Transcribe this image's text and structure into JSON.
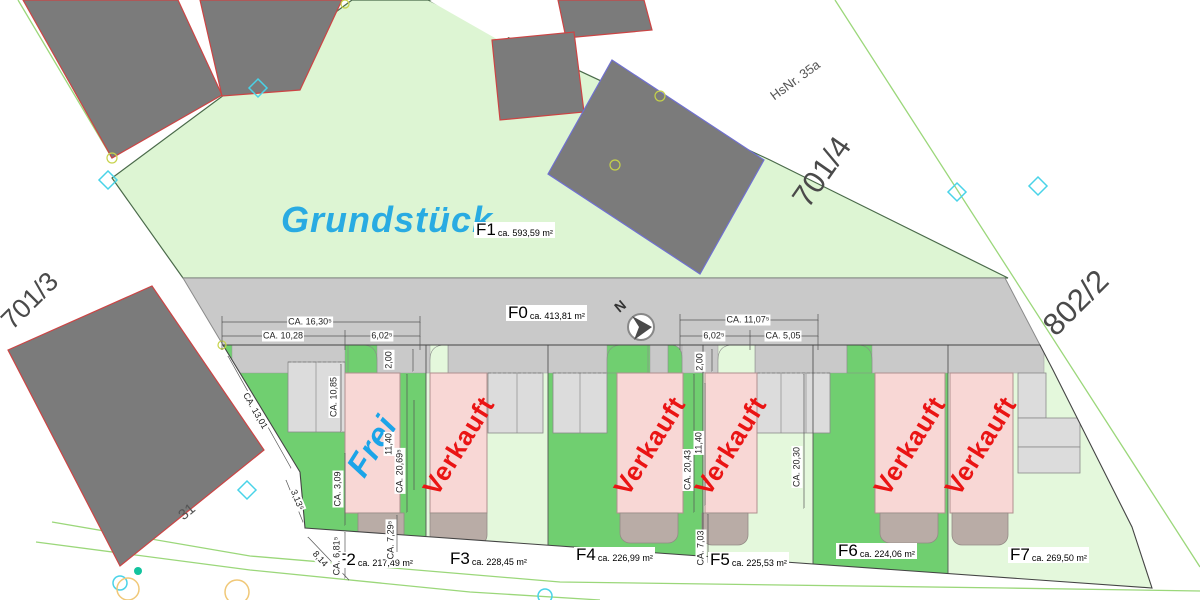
{
  "plan": {
    "grundstueck_label": "Grundstück",
    "north_label": "N",
    "parcel_labels": {
      "left": "701/3",
      "top_right": "701/4",
      "right": "802/2",
      "house_number": "HsNr. 35a",
      "building_31": "31"
    },
    "areas": {
      "f0": {
        "id": "F0",
        "area": "ca. 413,81 m²"
      },
      "f1": {
        "id": "F1",
        "area": "ca. 593,59 m²"
      },
      "f2": {
        "id": "F2",
        "area": "ca. 217,49 m²"
      },
      "f3": {
        "id": "F3",
        "area": "ca. 228,45 m²"
      },
      "f4": {
        "id": "F4",
        "area": "ca. 226,99 m²"
      },
      "f5": {
        "id": "F5",
        "area": "ca. 225,53 m²"
      },
      "f6": {
        "id": "F6",
        "area": "ca. 224,06 m²"
      },
      "f7": {
        "id": "F7",
        "area": "ca. 269,50 m²"
      }
    },
    "houses": [
      {
        "plot": "F2",
        "status": "Frei"
      },
      {
        "plot": "F3",
        "status": "Verkauft"
      },
      {
        "plot": "F4",
        "status": "Verkauft"
      },
      {
        "plot": "F5",
        "status": "Verkauft"
      },
      {
        "plot": "F6",
        "status": "Verkauft"
      },
      {
        "plot": "F7",
        "status": "Verkauft"
      }
    ],
    "dimensions": [
      "CA. 16,30⁵",
      "CA. 10,28",
      "6,02⁵",
      "2,00",
      "CA. 11,07⁵",
      "6,02⁵",
      "CA. 5,05",
      "2,00",
      "CA. 13,01",
      "3,13⁵",
      "CA. 10,85",
      "CA. 3,09",
      "CA. 6,81⁵",
      "8,14",
      "CA. 7,29⁵",
      "CA. 20,69⁵",
      "11,40",
      "CA. 20,43",
      "11,40",
      "CA. 20,30",
      "CA. 7,03"
    ],
    "colors": {
      "accent_blue": "#29abe2",
      "frei_blue": "#1ba4e8",
      "sold_red": "#ea1414",
      "plot_green_dark": "#70cf70",
      "plot_green_light": "#e4f8dc",
      "grundstueck_green": "#ddf5d3",
      "road_gray": "#c9c9c9",
      "building_gray": "#7b7b7b",
      "house_pink": "#f8d7d5",
      "cadastral_line_green": "#9bd77a"
    }
  }
}
